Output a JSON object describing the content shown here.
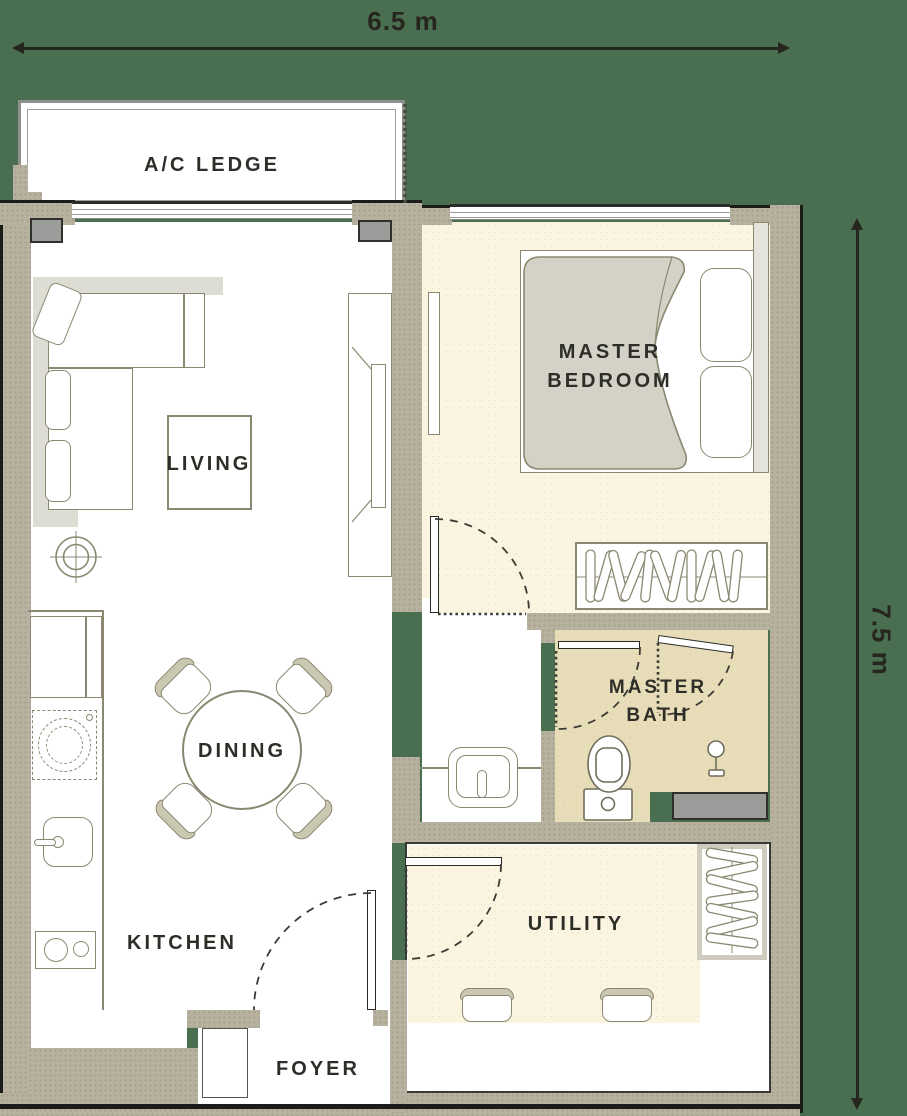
{
  "title": "Apartment floor plan",
  "dimensions": {
    "width_label": "6.5 m",
    "height_label": "7.5 m"
  },
  "rooms": {
    "ac_ledge": "A/C LEDGE",
    "master_bedroom": "MASTER BEDROOM",
    "living": "LIVING",
    "master_bath": "MASTER BATH",
    "dining": "DINING",
    "kitchen": "KITCHEN",
    "utility": "UTILITY",
    "foyer": "FOYER"
  },
  "colors": {
    "background_green": "#4a6f50",
    "wall_tan": "#b7b1a0",
    "floor_cream": "#faf4e1",
    "floor_bath_tan": "#e7ddb8",
    "floor_white": "#ffffff",
    "outline_olive": "#8b8871",
    "column_gray": "#9c9c9a",
    "text_dark": "#2e2e29",
    "dimension_dark": "#26261f"
  },
  "icons": {
    "bed": "double bed with duvet and two pillows",
    "sofa": "L-shaped sofa",
    "coffee-table": "square coffee table",
    "tv-console": "tv console",
    "floor-lamp": "ceiling light symbol",
    "dining-set": "round table with four chairs",
    "sink": "kitchen sink with tap",
    "cooktop": "two burner cooktop",
    "fridge": "refrigerator",
    "washer": "under-counter appliance (dashed)",
    "toilet": "toilet",
    "basin": "vanity basin with tap",
    "shower": "shower mixer",
    "wardrobe": "wardrobe with hangers",
    "door-swing": "door swing arc"
  }
}
